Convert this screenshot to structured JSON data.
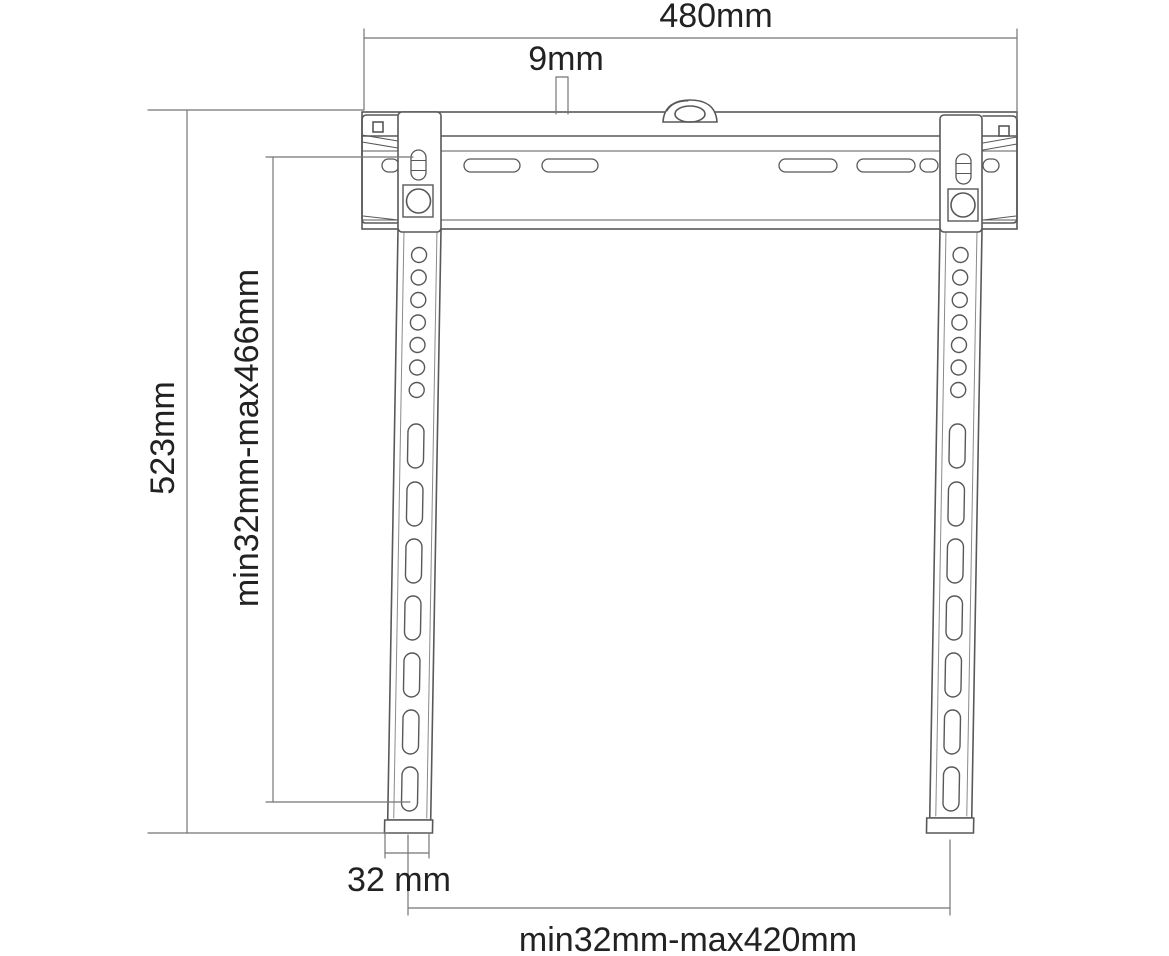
{
  "diagram": {
    "title": "TV wall mount bracket dimension drawing",
    "background_color": "#ffffff",
    "part_line_color": "#585858",
    "dimension_line_color": "#757575",
    "text_color": "#222222",
    "labels": {
      "width_top": "480mm",
      "tab_offset": "9mm",
      "height_total": "523mm",
      "vertical_hole_range": "min32mm-max466mm",
      "arm_width": "32 mm",
      "horizontal_hole_range": "min32mm-max420mm"
    }
  }
}
